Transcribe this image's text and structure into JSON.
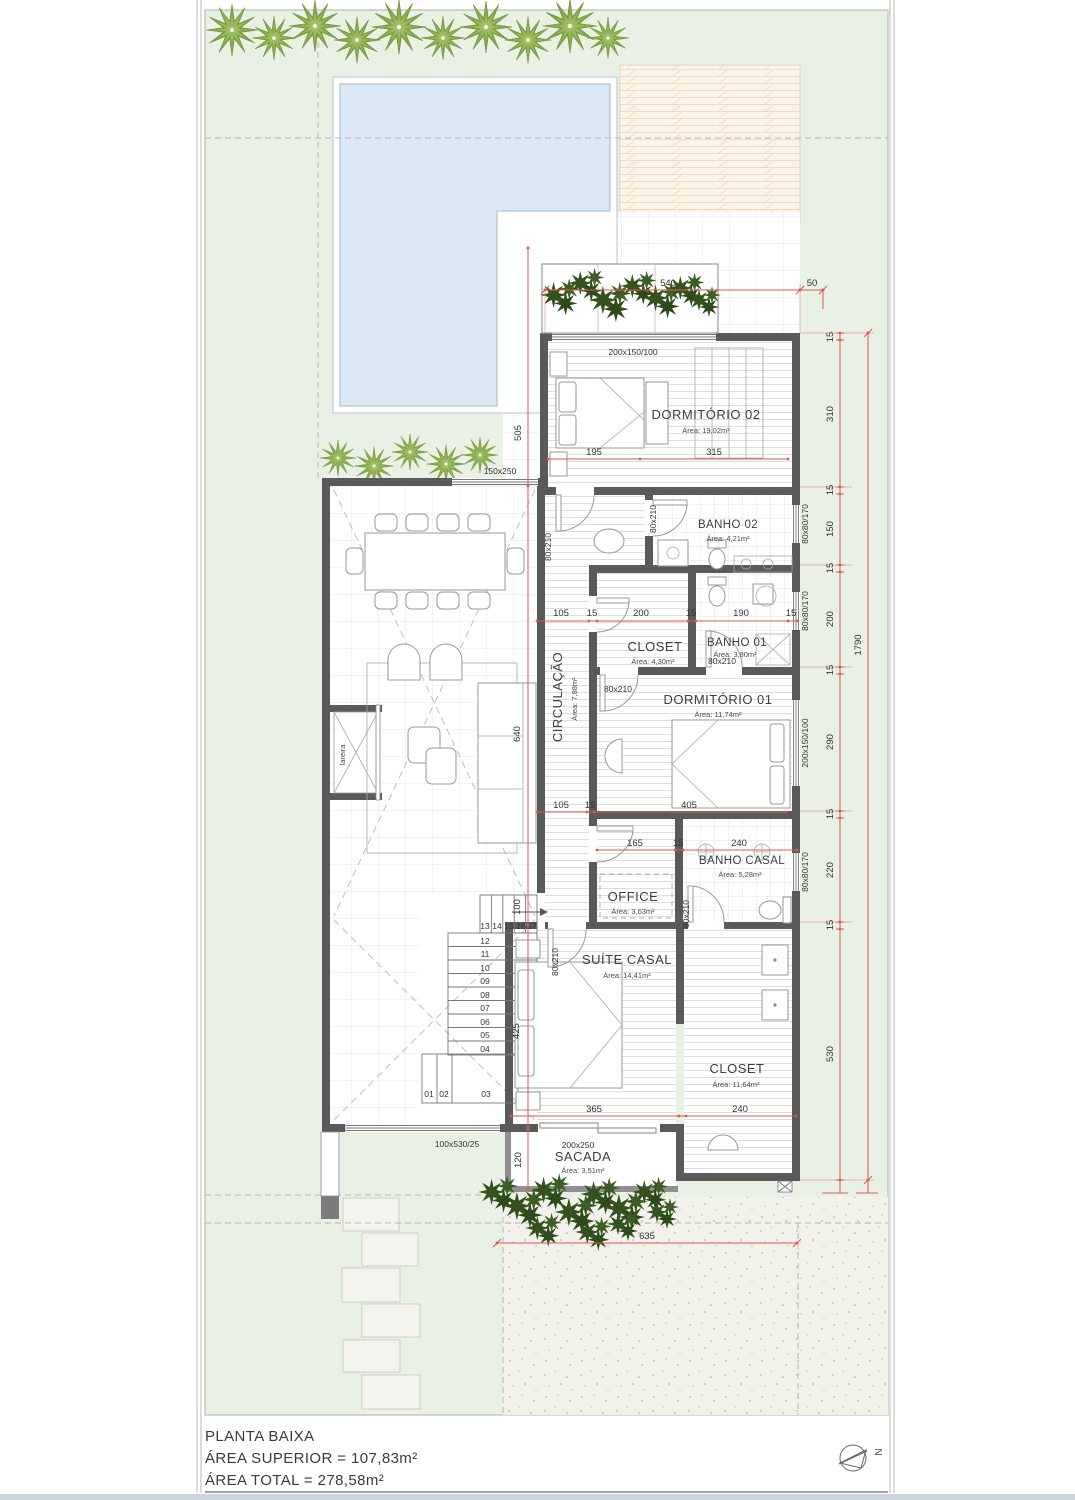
{
  "title_block": {
    "title": "PLANTA BAIXA",
    "line2": "ÁREA SUPERIOR = 107,83m²",
    "line3": "ÁREA TOTAL = 278,58m²"
  },
  "north_label": "N",
  "rooms": {
    "dormitorio02": {
      "name": "DORMITÓRIO 02",
      "area": "Área: 19,02m²"
    },
    "banho02": {
      "name": "BANHO 02",
      "area": "Área: 4,21m²"
    },
    "closet01": {
      "name": "CLOSET",
      "area": "Área: 4,30m²"
    },
    "banho01": {
      "name": "BANHO 01",
      "area": "Área: 3,80m²"
    },
    "dormitorio01": {
      "name": "DORMITÓRIO 01",
      "area": "Área: 11,74m²"
    },
    "circulacao": {
      "name": "CIRCULAÇÃO",
      "area": "Área: 7,88m²"
    },
    "office": {
      "name": "OFFICE",
      "area": "Área: 3,63m²"
    },
    "banho_casal": {
      "name": "BANHO CASAL",
      "area": "Área: 5,28m²"
    },
    "suite_casal": {
      "name": "SUÍTE CASAL",
      "area": "Área: 14,41m²"
    },
    "closet_casal": {
      "name": "CLOSET",
      "area": "Área: 11,64m²"
    },
    "sacada": {
      "name": "SACADA",
      "area": "Área: 3,51m²"
    },
    "lareira": "lareira"
  },
  "openings": {
    "door_label": "80x210",
    "win_dorm02": "200x150/100",
    "win_dorm01": "200x150/100",
    "win_small": "80x80/170",
    "win_living": "150x250",
    "win_front": "100x530/25",
    "win_sacada": "200x250"
  },
  "dims": {
    "d540": "540",
    "d50": "50",
    "right": [
      "15",
      "310",
      "15",
      "150",
      "15",
      "200",
      "15",
      "290",
      "15",
      "220",
      "15",
      "530"
    ],
    "total": "1790",
    "d505": "505",
    "d640": "640",
    "d425": "425",
    "d120": "120",
    "d100": "100",
    "row_dorm02": [
      "195",
      "315"
    ],
    "row_mid": [
      "105",
      "15",
      "200",
      "15",
      "190",
      "15"
    ],
    "row_dorm01": [
      "105",
      "15",
      "405"
    ],
    "row_office": [
      "165",
      "15",
      "240"
    ],
    "row_suite": [
      "365",
      "240"
    ],
    "d635": "635"
  },
  "stairs": {
    "top": [
      "13",
      "14",
      "15",
      "16",
      "17"
    ],
    "mid": [
      "12",
      "11",
      "10",
      "09",
      "08",
      "07",
      "06",
      "05",
      "04"
    ],
    "bottom": [
      "01",
      "02",
      "03"
    ]
  }
}
